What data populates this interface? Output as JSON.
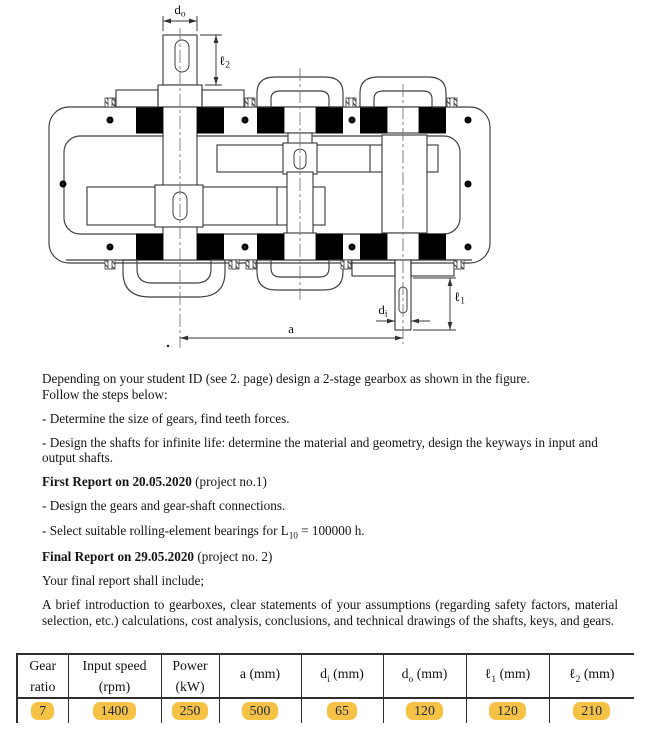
{
  "figure": {
    "caption": "2-stage gearbox sectional drawing",
    "dims": {
      "do_base": "d",
      "do_sub": "o",
      "l2_base": "ℓ",
      "l2_sub": "2",
      "l1_base": "ℓ",
      "l1_sub": "1",
      "di_base": "d",
      "di_sub": "i",
      "a": "a"
    }
  },
  "instructions": {
    "p1a": "Depending on your student ID (see 2. page) design a 2-stage gearbox as shown in the figure.",
    "p1b": "Follow the steps below:",
    "step1": "- Determine the size of gears, find teeth forces.",
    "step2": "- Design the shafts for infinite life: determine the material and geometry, design the keyways in input and output shafts.",
    "report1_bold": "First Report on 20.05.2020",
    "report1_rest": " (project no.1)",
    "step3": "- Design the gears and gear-shaft connections.",
    "step4_pre": "- Select suitable rolling-element bearings for L",
    "step4_sub": "10",
    "step4_post": " = 100000 h.",
    "report2_bold": "Final Report on 29.05.2020",
    "report2_rest": " (project no. 2)",
    "p2": "Your final report shall include;",
    "p3": "A brief introduction to gearboxes, clear statements of your assumptions (regarding safety factors, material selection, etc.) calculations, cost analysis, conclusions, and technical drawings of the shafts, keys, and gears."
  },
  "table": {
    "highlight_color": "#F6C245",
    "columns": [
      {
        "main": "Gear",
        "sub": "",
        "tail": "",
        "line2": "ratio",
        "value": "7"
      },
      {
        "main": "Input speed",
        "sub": "",
        "tail": "",
        "line2": "(rpm)",
        "value": "1400"
      },
      {
        "main": "Power",
        "sub": "",
        "tail": "",
        "line2": "(kW)",
        "value": "250"
      },
      {
        "main": "a",
        "sub": "",
        "tail": " (mm)",
        "line2": "",
        "value": "500"
      },
      {
        "main": "d",
        "sub": "i",
        "tail": " (mm)",
        "line2": "",
        "value": "65"
      },
      {
        "main": "d",
        "sub": "o",
        "tail": " (mm)",
        "line2": "",
        "value": "120"
      },
      {
        "main": "ℓ",
        "sub": "1",
        "tail": " (mm)",
        "line2": "",
        "value": "120"
      },
      {
        "main": "ℓ",
        "sub": "2",
        "tail": " (mm)",
        "line2": "",
        "value": "210"
      }
    ]
  }
}
